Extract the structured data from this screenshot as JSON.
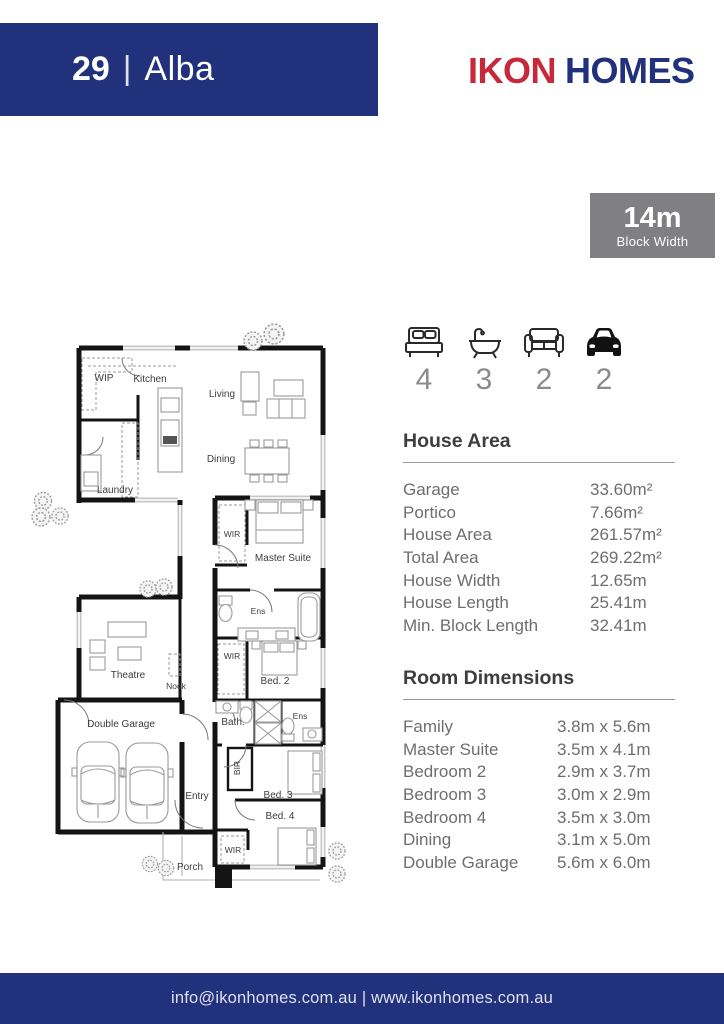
{
  "header": {
    "model_number": "29",
    "separator": "|",
    "model_name": "Alba",
    "brand_first": "IKON",
    "brand_second": "HOMES"
  },
  "badge": {
    "value": "14m",
    "label": "Block Width"
  },
  "features": [
    {
      "icon": "bed-icon",
      "count": "4"
    },
    {
      "icon": "bath-icon",
      "count": "3"
    },
    {
      "icon": "sofa-icon",
      "count": "2"
    },
    {
      "icon": "car-icon",
      "count": "2"
    }
  ],
  "house_area": {
    "title": "House Area",
    "rows": [
      {
        "label": "Garage",
        "value": "33.60m²"
      },
      {
        "label": "Portico",
        "value": "7.66m²"
      },
      {
        "label": "House Area",
        "value": "261.57m²"
      },
      {
        "label": "Total Area",
        "value": "269.22m²"
      },
      {
        "label": "House Width",
        "value": "12.65m"
      },
      {
        "label": "House Length",
        "value": "25.41m"
      },
      {
        "label": "Min. Block Length",
        "value": "32.41m"
      }
    ]
  },
  "room_dimensions": {
    "title": "Room Dimensions",
    "rows": [
      {
        "label": "Family",
        "value": "3.8m x 5.6m"
      },
      {
        "label": "Master Suite",
        "value": "3.5m x 4.1m"
      },
      {
        "label": "Bedroom 2",
        "value": "2.9m x 3.7m"
      },
      {
        "label": "Bedroom 3",
        "value": "3.0m x 2.9m"
      },
      {
        "label": "Bedroom 4",
        "value": "3.5m x 3.0m"
      },
      {
        "label": "Dining",
        "value": "3.1m x 5.0m"
      },
      {
        "label": "Double Garage",
        "value": "5.6m x 6.0m"
      }
    ]
  },
  "floor_plan": {
    "labels": [
      "WIP",
      "Kitchen",
      "Living",
      "Dining",
      "Laundry",
      "WIR",
      "Master Suite",
      "Ens",
      "WIR",
      "Bed. 2",
      "Theatre",
      "Nook",
      "Double Garage",
      "Bath.",
      "Ens",
      "BIR",
      "Entry",
      "Bed. 3",
      "Bed. 4",
      "WIR",
      "Porch"
    ]
  },
  "footer": {
    "text": "info@ikonhomes.com.au | www.ikonhomes.com.au"
  },
  "colors": {
    "navy": "#21317b",
    "red": "#c5293a",
    "badge_gray": "#808083",
    "text_gray": "#6e6e6e"
  }
}
